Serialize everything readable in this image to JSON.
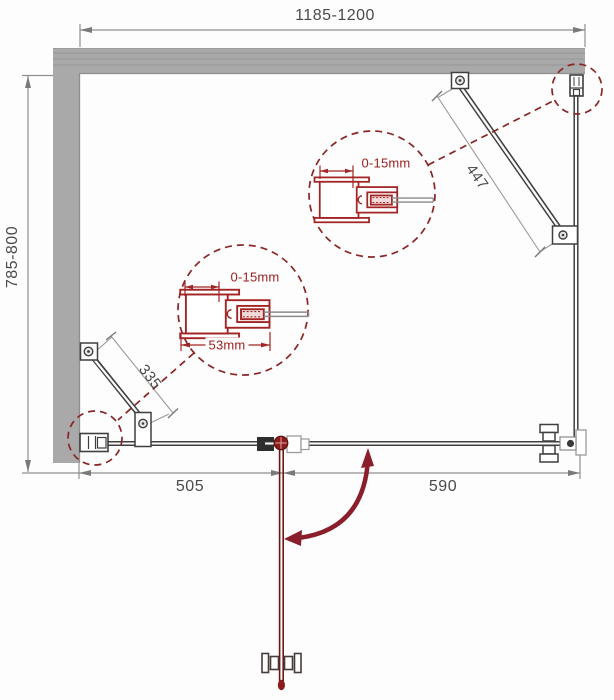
{
  "dimensions": {
    "top_width": "1185-1200",
    "left_height": "785-800",
    "bottom_left_segment": "505",
    "bottom_right_segment": "590",
    "upper_support_bar": "447",
    "lower_support_bar": "335"
  },
  "detail_callouts": {
    "upper": {
      "adjustment_range": "0-15mm"
    },
    "lower": {
      "adjustment_range": "0-15mm",
      "profile_width": "53mm"
    }
  },
  "colors": {
    "wall_gray": "#a9a9a9",
    "frame_dark": "#3f3f3f",
    "dimension_gray": "#8f8f8f",
    "dimension_text": "#4a4a4a",
    "detail_red": "#a32424",
    "door_dark_red": "#8b1e2b"
  }
}
